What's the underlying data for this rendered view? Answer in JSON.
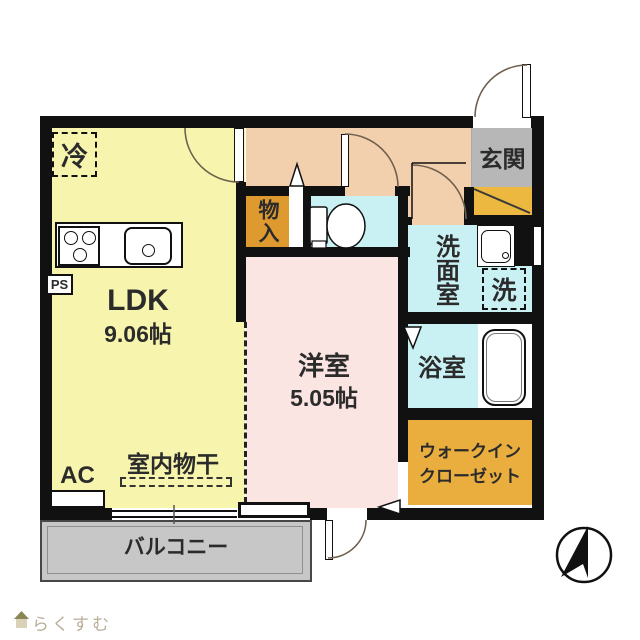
{
  "title": "apartment-floor-plan",
  "rooms": {
    "ldk": {
      "name": "LDK",
      "area": "9.06帖"
    },
    "western": {
      "name": "洋室",
      "area": "5.05帖"
    },
    "entrance": {
      "name": "玄関"
    },
    "storage": {
      "name": "物入"
    },
    "washroom": {
      "name": "洗面室"
    },
    "washer": {
      "name": "洗"
    },
    "bathroom": {
      "name": "浴室"
    },
    "wic": {
      "line1": "ウォークイン",
      "line2": "クローゼット"
    },
    "balcony": {
      "name": "バルコニー"
    }
  },
  "annotations": {
    "fridge": "冷",
    "ac": "AC",
    "ps": "PS",
    "indoor_drying": "室内物干"
  },
  "watermark": {
    "brand": "らくすむ"
  },
  "icons": [
    "north-compass-icon",
    "house-logo-icon"
  ],
  "colors": {
    "wall": "#111111",
    "ldk_fill": "#f7f5ad",
    "hall_fill": "#f3d0ad",
    "western_fill": "#fbe5e3",
    "wet_fill": "#c9f1f3",
    "storage_fill": "#df9a2f",
    "wic_fill": "#e9ae3e",
    "shoe_fill": "#ecb83f",
    "entrance_fill": "#b7b7b7",
    "balcony_fill": "#c7c7c7",
    "arc": "#6f6050",
    "text": "#2b2b2b",
    "watermark": "#b9af99"
  }
}
